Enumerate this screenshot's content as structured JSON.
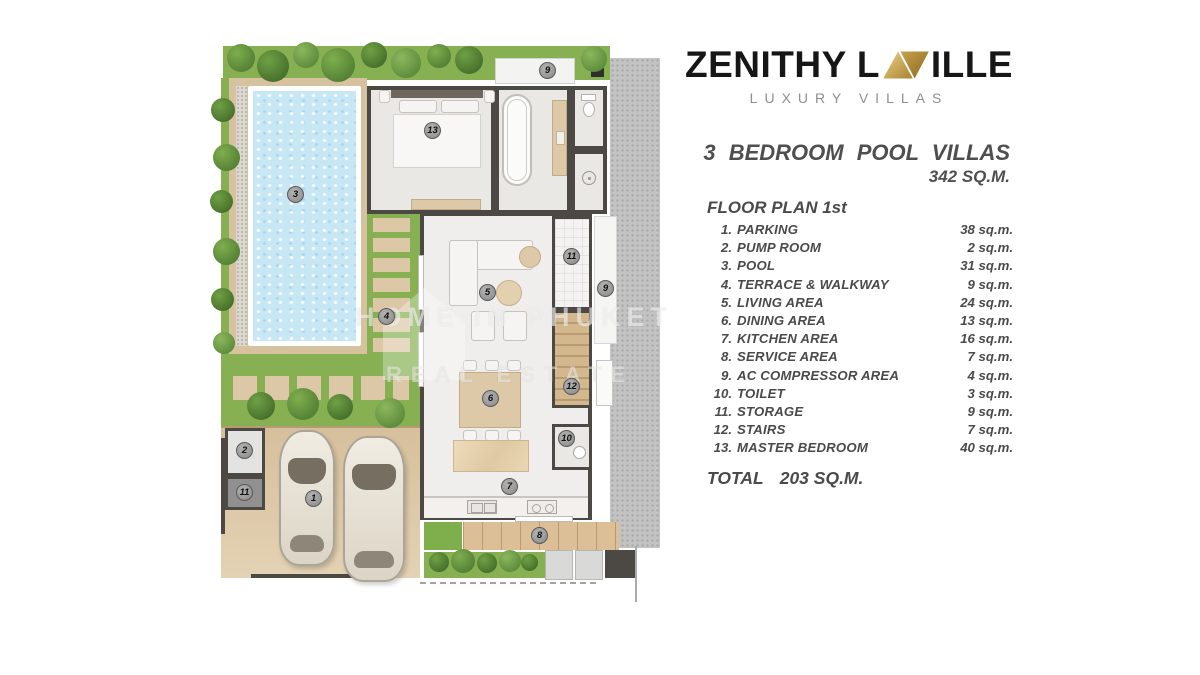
{
  "brand": {
    "name_left": "ZENITHY L",
    "name_right": "ILLE",
    "tagline": "LUXURY VILLAS",
    "gold_light": "#e9c977",
    "gold_dark": "#8f6d22"
  },
  "header": {
    "title": "3 BEDROOM POOL VILLAS",
    "project_area": "342 SQ.M.",
    "plan_heading": "FLOOR PLAN 1st"
  },
  "rooms": [
    {
      "id": "1",
      "num": "1.",
      "name": "PARKING",
      "area": "38 sq.m."
    },
    {
      "id": "2",
      "num": "2.",
      "name": "PUMP ROOM",
      "area": "2 sq.m."
    },
    {
      "id": "3",
      "num": "3.",
      "name": "POOL",
      "area": "31 sq.m."
    },
    {
      "id": "4",
      "num": "4.",
      "name": "TERRACE & WALKWAY",
      "area": "9 sq.m."
    },
    {
      "id": "5",
      "num": "5.",
      "name": "LIVING AREA",
      "area": "24 sq.m."
    },
    {
      "id": "6",
      "num": "6.",
      "name": "DINING AREA",
      "area": "13 sq.m."
    },
    {
      "id": "7",
      "num": "7.",
      "name": "KITCHEN AREA",
      "area": "16 sq.m."
    },
    {
      "id": "8",
      "num": "8.",
      "name": "SERVICE AREA",
      "area": "7 sq.m."
    },
    {
      "id": "9",
      "num": "9.",
      "name": "AC COMPRESSOR AREA",
      "area": "4 sq.m."
    },
    {
      "id": "10",
      "num": "10.",
      "name": "TOILET",
      "area": "3 sq.m."
    },
    {
      "id": "11",
      "num": "11.",
      "name": "STORAGE",
      "area": "9 sq.m."
    },
    {
      "id": "12",
      "num": "12.",
      "name": "STAIRS",
      "area": "7 sq.m."
    },
    {
      "id": "13",
      "num": "13.",
      "name": "MASTER BEDROOM",
      "area": "40 sq.m."
    }
  ],
  "total": {
    "label": "TOTAL",
    "value": "203 SQ.M."
  },
  "watermark": {
    "line1": "HOME IN PHUKET",
    "line2": "REAL ESTATE"
  },
  "colors": {
    "garden": "#86b052",
    "pool": "#c7e7f5",
    "deck": "#d7c2a0",
    "wall": "#4c4844",
    "gravel": "#c3c3c3"
  }
}
